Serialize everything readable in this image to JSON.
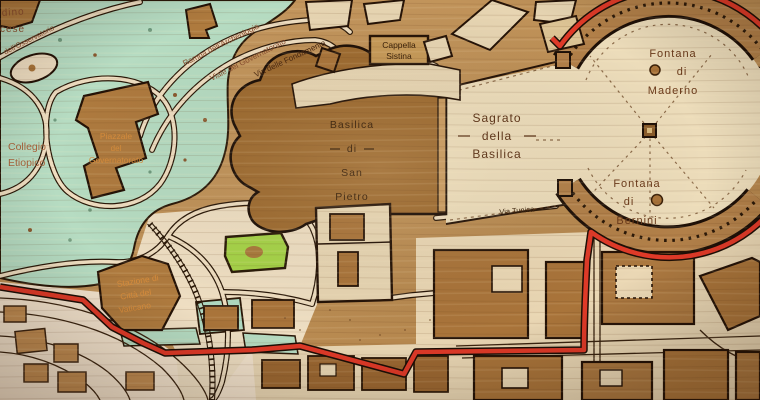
{
  "map": {
    "title": "Wooden engraved map of Vatican City — St. Peter's Basilica area",
    "labels": {
      "giardino": [
        "dino",
        "cese"
      ],
      "osservatorio": "dell'Osservatorio",
      "rampa": "Rampa dell'Archeologia",
      "viale": "Viale del Governatorato",
      "fondamenta": "Via delle Fondamenta",
      "collegio": [
        "Collegio",
        "Etiopico"
      ],
      "piazzale": [
        "Piazzale",
        "del",
        "Governatorato"
      ],
      "basilica": [
        "Basilica",
        "di",
        "San",
        "Pietro"
      ],
      "cappella": [
        "Cappella",
        "Sistina"
      ],
      "sagrato": [
        "Sagrato",
        "della",
        "Basilica"
      ],
      "maderno": [
        "Fontana",
        "di",
        "Maderno"
      ],
      "bernini": [
        "Fontana",
        "di",
        "Bernini"
      ],
      "via_tunica": "Via Tunica",
      "stazione": [
        "Stazione di",
        "Città del",
        "Vaticano"
      ]
    },
    "palette": {
      "wood_base": "#bf9257",
      "wood_dark_building": "#9e6b30",
      "building_brown": "#ae7a3e",
      "cream": "#ecdcba",
      "cream_pink": "#f3e3cd",
      "garden_green": "#b6dcc2",
      "lawn_green": "#a6d348",
      "border_red": "#e03a28",
      "outline_dark": "#241206",
      "label_dark": "#3a2008",
      "label_orange": "#d68c3c",
      "label_red_brown": "#8a4e2e"
    }
  }
}
